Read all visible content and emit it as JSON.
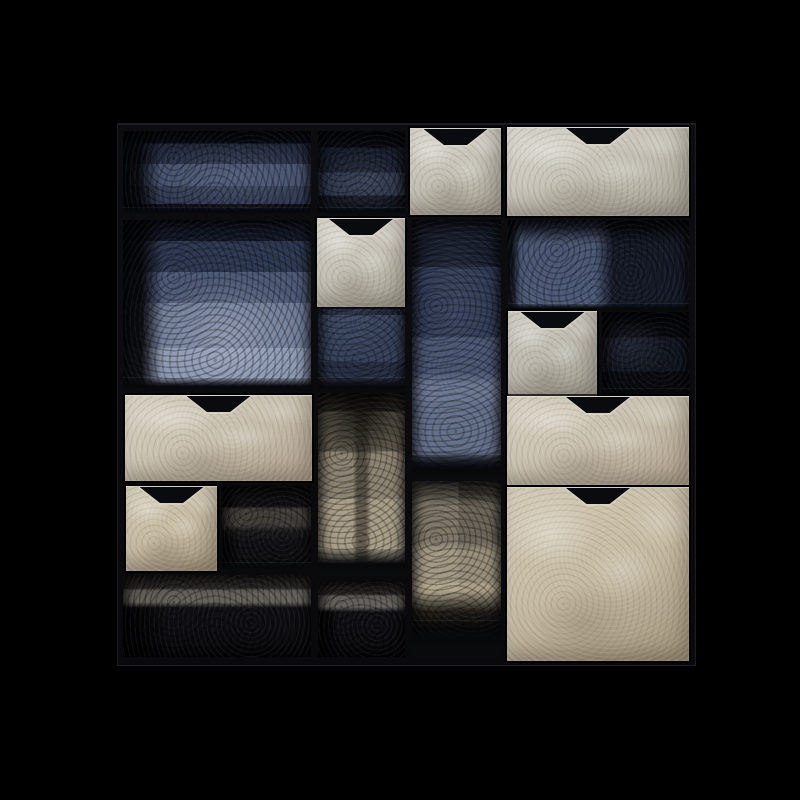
{
  "scene": {
    "type": "product-photograph",
    "subject": "Black modular shelving unit with staggered cube compartments, forest-photo print back panels (cool blue above, warm sepia below) and pale stone-grey drawers with trapezoid notch handles",
    "background_color": "#000000",
    "drawer_count": 8,
    "open_compartment_count": 12
  },
  "palette": {
    "background": "#000000",
    "frame": "#0b0b0e",
    "frame_edge": "#1c1d23",
    "drawer_light": "#cdc9be",
    "drawer_beige": "#c8bda6",
    "print_blue_light": "#8794ae",
    "print_blue_mid": "#4d5775",
    "print_blue_dark": "#171c2a",
    "print_warm_light": "#b0a68f",
    "print_warm_dark": "#2a261f",
    "notch": "#0a0b0e"
  },
  "unit": {
    "x": 117,
    "y": 123,
    "w": 577,
    "h": 541
  },
  "notch": {
    "w": 64,
    "h": 16
  },
  "cells": [
    {
      "id": "compartment-top-left",
      "x": 122,
      "y": 130,
      "w": 188,
      "h": 83,
      "print": "blue-dim",
      "floor": 6
    },
    {
      "id": "compartment-top-mid",
      "x": 317,
      "y": 130,
      "w": 87,
      "h": 83,
      "print": "blue-dark",
      "floor": 6
    },
    {
      "id": "compartment-mid-left-tall",
      "x": 122,
      "y": 219,
      "w": 188,
      "h": 173,
      "print": "blue-bright",
      "floor": 15
    },
    {
      "id": "compartment-mid-center-tall",
      "x": 317,
      "y": 219,
      "w": 87,
      "h": 173,
      "print": "blue-dark2",
      "floor": 15
    },
    {
      "id": "compartment-center-tall",
      "x": 411,
      "y": 219,
      "w": 89,
      "h": 261,
      "print": "blue-mid",
      "floor": 26
    },
    {
      "id": "compartment-upper-right-wide",
      "x": 507,
      "y": 219,
      "w": 181,
      "h": 92,
      "print": "blue-patch",
      "floor": 8
    },
    {
      "id": "compartment-right-small",
      "x": 601,
      "y": 311,
      "w": 87,
      "h": 85,
      "print": "blue-verydark",
      "floor": 8
    },
    {
      "id": "compartment-center-trunk",
      "x": 317,
      "y": 392,
      "w": 87,
      "h": 183,
      "print": "warm-trunk",
      "floor": 27
    },
    {
      "id": "compartment-center-lower",
      "x": 411,
      "y": 480,
      "w": 89,
      "h": 176,
      "print": "warm-mid",
      "floor": 36
    },
    {
      "id": "compartment-left-of-bottom",
      "x": 221,
      "y": 485,
      "w": 89,
      "h": 85,
      "print": "warm-dark",
      "floor": 8
    },
    {
      "id": "compartment-bottom-left-wide",
      "x": 122,
      "y": 574,
      "w": 188,
      "h": 82,
      "print": "warm-band",
      "floor": 0
    },
    {
      "id": "compartment-bottom-mid",
      "x": 317,
      "y": 581,
      "w": 87,
      "h": 75,
      "print": "warm-band",
      "floor": 0
    }
  ],
  "drawers": [
    {
      "id": "drawer-top-small",
      "x": 409,
      "y": 127,
      "w": 91,
      "h": 86,
      "tone": "cool-light"
    },
    {
      "id": "drawer-top-wide",
      "x": 506,
      "y": 126,
      "w": 182,
      "h": 88,
      "tone": "cool-light"
    },
    {
      "id": "drawer-upper-center",
      "x": 316,
      "y": 217,
      "w": 88,
      "h": 88,
      "tone": "cool-light"
    },
    {
      "id": "drawer-mid-right-small",
      "x": 507,
      "y": 310,
      "w": 89,
      "h": 86,
      "tone": "cool-mid"
    },
    {
      "id": "drawer-mid-left-wide",
      "x": 124,
      "y": 394,
      "w": 187,
      "h": 85,
      "tone": "warm-light"
    },
    {
      "id": "drawer-lower-left-small",
      "x": 125,
      "y": 485,
      "w": 91,
      "h": 84,
      "tone": "warm-beige"
    },
    {
      "id": "drawer-mid-right-wide",
      "x": 506,
      "y": 395,
      "w": 182,
      "h": 88,
      "tone": "warm-light"
    },
    {
      "id": "drawer-bottom-right-large",
      "x": 506,
      "y": 486,
      "w": 182,
      "h": 173,
      "tone": "warm-beige"
    }
  ]
}
